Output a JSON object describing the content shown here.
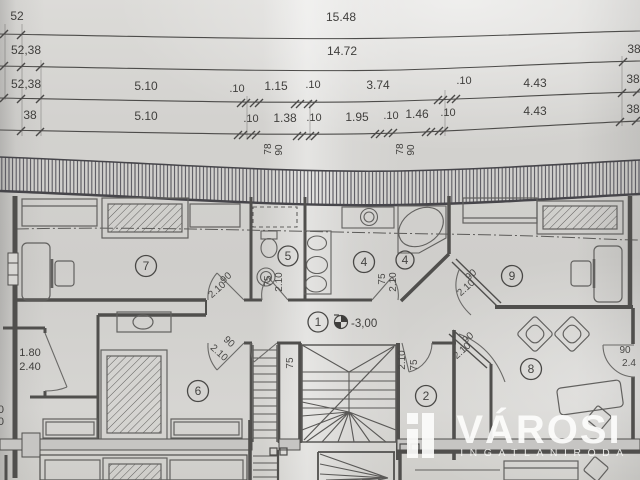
{
  "dims": {
    "row1": {
      "left": "52",
      "total": "15.48"
    },
    "row2": {
      "left": "52,38",
      "total": "14.72",
      "right": "38"
    },
    "row3": {
      "left": "52,38",
      "a": "5.10",
      "b": ".10",
      "c": "1.15",
      "d": ".10",
      "e": "3.74",
      "f": ".10",
      "g": "4.43",
      "right": "38"
    },
    "row4": {
      "left": "38",
      "a": "5.10",
      "b": ".10",
      "c": "1.38",
      "d": ".10",
      "e": "1.95",
      "f": ".10",
      "g": "1.46",
      "h": ".10",
      "i": "4.43",
      "right": "38"
    },
    "win1_78": "78",
    "win1_90": "90",
    "win2_78": "78",
    "win2_90": "90"
  },
  "rooms": {
    "r1": "1",
    "r2": "2",
    "r4a": "4",
    "r4b": "4",
    "r5": "5",
    "r6": "6",
    "r7": "7",
    "r8": "8",
    "r9": "9"
  },
  "level": {
    "value": "-3,00"
  },
  "doors": {
    "room7": {
      "w": "90",
      "h": "2.10"
    },
    "room6": {
      "w": "90",
      "h": "2.10"
    },
    "room9": {
      "w": "90",
      "h": "2.10"
    },
    "room8": {
      "w": "90",
      "h": "2.10"
    },
    "room5": {
      "w": "75",
      "h": "2.10"
    },
    "room4": {
      "w": "75",
      "h": "2.10"
    },
    "stair_left": {
      "w": "75"
    },
    "stair_right": {
      "h": "2.10",
      "w": "75"
    },
    "entry": {
      "w": "1.80",
      "h": "2.40"
    },
    "room8_right": {
      "w": "90",
      "h": "2.4"
    },
    "left_edge": {
      "w": "90",
      "h": "40"
    }
  },
  "logo": {
    "brand": "VÁROSI",
    "tagline": "INGATLANIRODA"
  }
}
